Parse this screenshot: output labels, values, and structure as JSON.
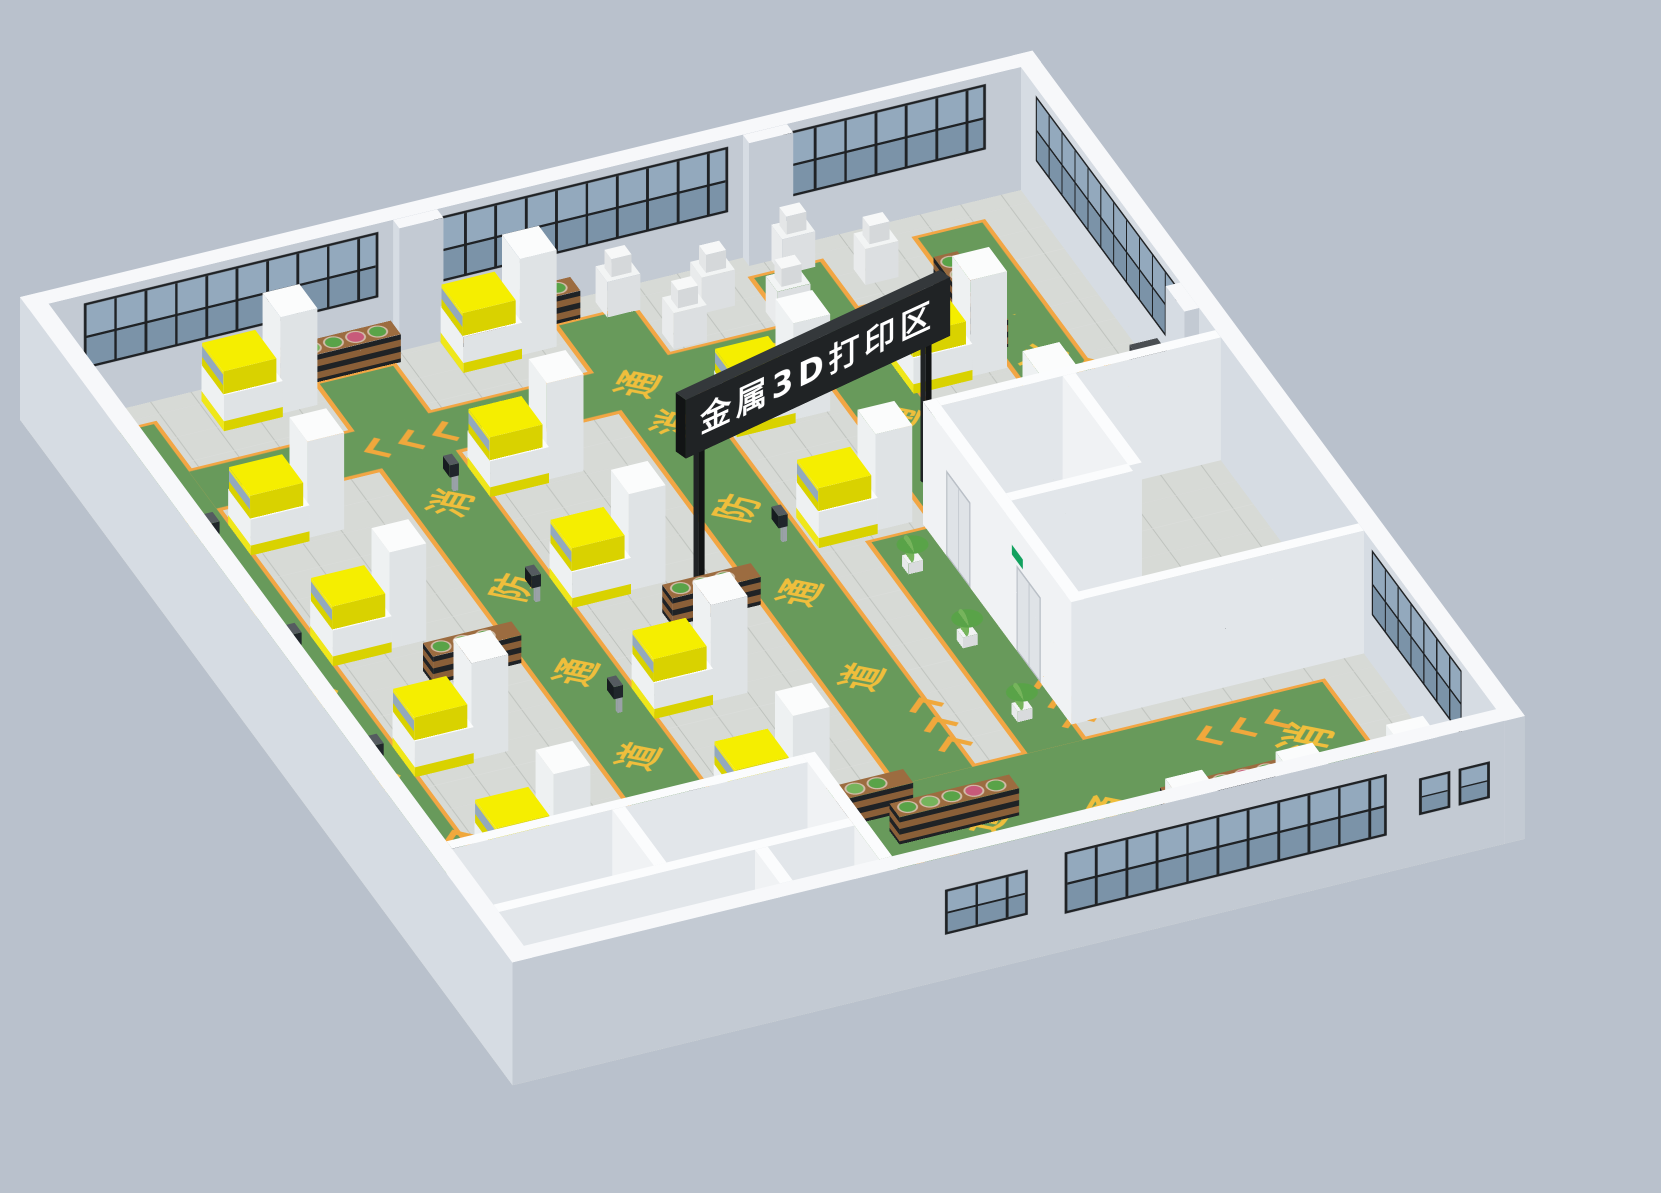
{
  "title": "metal-3d-printing-zone-isometric-factory-render",
  "sign": {
    "text": "金属3D打印区"
  },
  "floor_markings": {
    "phrase": "消防通道",
    "chars": [
      "消",
      "防",
      "通",
      "道"
    ],
    "chevron_count": 3
  },
  "colors": {
    "background": "#b9c1cc",
    "wall_top": "#f7f8fa",
    "wall_west": "#d6dce3",
    "wall_south": "#c3cad3",
    "inner_wall_top": "#fbfcfd",
    "inner_wall_west": "#f0f2f4",
    "inner_wall_south": "#e2e6ea",
    "floor": "#d7dad6",
    "lane_green": "#689a5b",
    "lane_border": "#f2a644",
    "mark_yellow": "#efbe3c",
    "chevron_orange": "#f0a83c",
    "machine_top": "#fbfcfc",
    "machine_west": "#eef1f2",
    "machine_south": "#dfe3e5",
    "yellow_top": "#f5ee00",
    "yellow_west": "#efe71a",
    "yellow_south": "#d9d200",
    "glass": "#93a9bd",
    "glass_dark": "#7b93a8",
    "frame": "#1f2225",
    "wood": "#8a5f38",
    "wood_top": "#9c6c40",
    "leaf": "#59a348",
    "leaf2": "#76b45c",
    "flower": "#c85a7a",
    "concrete": "#ecece9",
    "void": "#383d40",
    "sign_bg": "#202325",
    "sign_top": "#34383b",
    "sign_side": "#121415",
    "sign_text": "#ffffff",
    "exit_green": "#12a15e",
    "door": "#dfe3e7",
    "door_frame": "#b9bfc6",
    "beige": "#e8e3d3",
    "beige_dark": "#d8d2bf",
    "red": "#c23b2e",
    "mat": "#8a6b4c",
    "metal": "#9aa1a7",
    "screen": "#20262b",
    "pot": "#f2f3f4",
    "rail": "#dde1e4"
  },
  "scene": {
    "floor": {
      "w": 1100,
      "d": 1260,
      "wall_h": 150,
      "wall_t": 22
    },
    "camera": {
      "left": 20,
      "top": 420,
      "rx": 55,
      "rz": -23
    },
    "lanes": [
      {
        "name": "west-aisle",
        "x": 40,
        "y": 60,
        "w": 80,
        "d": 1000,
        "dir": "y",
        "marks": [
          {
            "t": "消",
            "o": 160
          },
          {
            "t": "防",
            "o": 320
          },
          {
            "t": "通",
            "o": 480
          },
          {
            "t": "道",
            "o": 640
          },
          {
            "t": "chev",
            "o": 810
          }
        ]
      },
      {
        "name": "aisle-2",
        "x": 300,
        "y": 60,
        "w": 80,
        "d": 1000,
        "dir": "y",
        "marks": [
          {
            "t": "消",
            "o": 220
          },
          {
            "t": "防",
            "o": 380
          },
          {
            "t": "通",
            "o": 540
          },
          {
            "t": "道",
            "o": 700
          },
          {
            "t": "chev",
            "o": 860
          }
        ]
      },
      {
        "name": "aisle-3",
        "x": 560,
        "y": 60,
        "w": 80,
        "d": 870,
        "dir": "y",
        "marks": [
          {
            "t": "消",
            "o": 180
          },
          {
            "t": "防",
            "o": 340
          },
          {
            "t": "通",
            "o": 500
          },
          {
            "t": "道",
            "o": 660
          },
          {
            "t": "chev",
            "o": 780
          }
        ]
      },
      {
        "name": "aisle-4",
        "x": 772,
        "y": 60,
        "w": 72,
        "d": 450,
        "dir": "y",
        "marks": [
          {
            "t": "消",
            "o": 140
          },
          {
            "t": "通",
            "o": 260
          },
          {
            "t": "chev",
            "o": 360
          }
        ]
      },
      {
        "name": "east-aisle",
        "x": 950,
        "y": 60,
        "w": 70,
        "d": 370,
        "dir": "y",
        "marks": [
          {
            "t": "防",
            "o": 110
          },
          {
            "t": "消",
            "o": 220
          },
          {
            "t": "chev",
            "o": 300
          }
        ]
      },
      {
        "name": "north-aisle",
        "x": 120,
        "y": 150,
        "w": 900,
        "d": 70,
        "dir": "x",
        "marks": [
          {
            "t": "chev",
            "o": 180
          },
          {
            "t": "道",
            "o": 310
          },
          {
            "t": "通",
            "o": 450
          },
          {
            "t": "防",
            "o": 590
          },
          {
            "t": "消",
            "o": 730
          }
        ]
      },
      {
        "name": "south-plaza",
        "x": 430,
        "y": 930,
        "w": 590,
        "d": 230,
        "dir": "x",
        "marks": [
          {
            "t": "chev",
            "o": 60,
            "cy": 120
          },
          {
            "t": "道",
            "o": 160,
            "cy": 60,
            "s": 54
          },
          {
            "t": "通",
            "o": 280,
            "cy": 100,
            "s": 54
          },
          {
            "t": "防",
            "o": 400,
            "cy": 140,
            "s": 54
          },
          {
            "t": "消",
            "o": 510,
            "cy": 60,
            "s": 54
          },
          {
            "t": "chev",
            "o": 440,
            "cy": 30
          }
        ]
      },
      {
        "name": "east-plaza",
        "x": 700,
        "y": 530,
        "w": 60,
        "d": 400,
        "dir": "y",
        "marks": [
          {
            "t": "chev",
            "o": 320
          }
        ]
      }
    ],
    "printers": [
      {
        "x": 120,
        "y": 250,
        "c": 1
      },
      {
        "x": 120,
        "y": 460,
        "c": 1
      },
      {
        "x": 120,
        "y": 670,
        "c": 1
      },
      {
        "x": 120,
        "y": 880,
        "c": 1
      },
      {
        "x": 380,
        "y": 250,
        "c": 1
      },
      {
        "x": 380,
        "y": 460,
        "c": 1
      },
      {
        "x": 380,
        "y": 670,
        "c": 1
      },
      {
        "x": 380,
        "y": 880,
        "c": 1
      },
      {
        "x": 648,
        "y": 250,
        "c": 0
      },
      {
        "x": 648,
        "y": 460,
        "c": 1
      },
      {
        "x": 840,
        "y": 250,
        "c": 0
      },
      {
        "x": 840,
        "y": 430,
        "c": 0
      },
      {
        "x": 180,
        "y": 40,
        "c": 0
      },
      {
        "x": 440,
        "y": 40,
        "c": 0
      },
      {
        "x": 680,
        "y": 1172,
        "c": 1
      },
      {
        "x": 800,
        "y": 1172,
        "c": 1
      },
      {
        "x": 920,
        "y": 1172,
        "c": 1
      }
    ],
    "stations": [
      {
        "x": 610,
        "y": 36
      },
      {
        "x": 700,
        "y": 66
      },
      {
        "x": 800,
        "y": 36
      },
      {
        "x": 870,
        "y": 84
      },
      {
        "x": 650,
        "y": 112
      },
      {
        "x": 760,
        "y": 118
      }
    ],
    "shelves": [
      {
        "x": 260,
        "y": 30
      },
      {
        "x": 455,
        "y": 30
      },
      {
        "x": 200,
        "y": 560,
        "w": 96
      },
      {
        "x": 460,
        "y": 560,
        "w": 96
      },
      {
        "x": 200,
        "y": 950,
        "w": 96
      },
      {
        "x": 460,
        "y": 950,
        "w": 96
      },
      {
        "x": 933,
        "y": 140,
        "v": 1
      },
      {
        "x": 520,
        "y": 1000
      },
      {
        "x": 780,
        "y": 1080
      },
      {
        "x": 540,
        "y": 1208,
        "w": 90
      }
    ],
    "pots": [
      {
        "x": 712,
        "y": 580
      },
      {
        "x": 712,
        "y": 720
      },
      {
        "x": 712,
        "y": 860
      }
    ],
    "cnc": {
      "x": 960,
      "y": 452,
      "mat": {
        "x": 945,
        "y": 440,
        "w": 120,
        "d": 84
      }
    },
    "rooms_e": {
      "walls": [
        {
          "x": 760,
          "y": 520,
          "w": 14,
          "d": 380
        },
        {
          "x": 774,
          "y": 520,
          "w": 304,
          "d": 14
        },
        {
          "x": 906,
          "y": 534,
          "w": 14,
          "d": 170
        },
        {
          "x": 774,
          "y": 700,
          "w": 132,
          "d": 14
        },
        {
          "x": 760,
          "y": 886,
          "w": 318,
          "d": 14
        }
      ],
      "doors_local_x": [
        60,
        240
      ],
      "exit_sign_local_x": 228,
      "concrete": {
        "x": 774,
        "y": 714,
        "w": 290,
        "d": 158
      },
      "void": {
        "x": 860,
        "y": 760,
        "w": 150,
        "d": 80
      },
      "rails": [
        {
          "x": 860,
          "y": 752,
          "w": 150,
          "d": 4
        },
        {
          "x": 1006,
          "y": 760,
          "w": 4,
          "d": 80
        }
      ]
    },
    "rooms_sw": {
      "walls": [
        {
          "x": 22,
          "y": 1040,
          "w": 386,
          "d": 14
        },
        {
          "x": 408,
          "y": 1040,
          "w": 14,
          "d": 198
        },
        {
          "x": 196,
          "y": 1054,
          "w": 14,
          "d": 106
        },
        {
          "x": 22,
          "y": 1160,
          "w": 386,
          "d": 14
        },
        {
          "x": 300,
          "y": 1174,
          "w": 14,
          "d": 64
        }
      ],
      "platform": {
        "x": 422,
        "y": 1160,
        "w": 234,
        "d": 78
      },
      "void": {
        "x": 545,
        "y": 1164,
        "w": 105,
        "d": 70
      },
      "steps": {
        "x": 428,
        "y": 1168,
        "n": 9,
        "sw": 13,
        "sd": 64,
        "h0": 96,
        "dh": 10
      },
      "rail": {
        "x": 428,
        "y": 1160,
        "w": 130,
        "d": 4
      }
    },
    "windows": {
      "north": [
        {
          "x": 60,
          "w": 320
        },
        {
          "x": 440,
          "w": 320
        },
        {
          "x": 820,
          "w": 220
        }
      ],
      "east": [
        {
          "x": 60,
          "w": 360
        },
        {
          "x": 920,
          "w": 230
        }
      ],
      "south": [
        {
          "x": 600,
          "w": 350,
          "y": 30,
          "h": 75
        },
        {
          "x": 470,
          "w": 90,
          "y": 40,
          "h": 55
        },
        {
          "x": 985,
          "w": 34,
          "y": 45,
          "h": 45
        },
        {
          "x": 1028,
          "w": 34,
          "y": 45,
          "h": 45
        }
      ]
    },
    "pillars": [
      {
        "x": 396,
        "y": 22,
        "w": 48,
        "d": 16
      },
      {
        "x": 776,
        "y": 22,
        "w": 48,
        "d": 16
      },
      {
        "x": 1062,
        "y": 430,
        "w": 16,
        "d": 48
      }
    ],
    "sign": {
      "x": 490,
      "y": 540,
      "rot": -16,
      "len": 340,
      "post_h": 230,
      "board_z": 170,
      "board_h": 72,
      "board_d": 16
    }
  }
}
